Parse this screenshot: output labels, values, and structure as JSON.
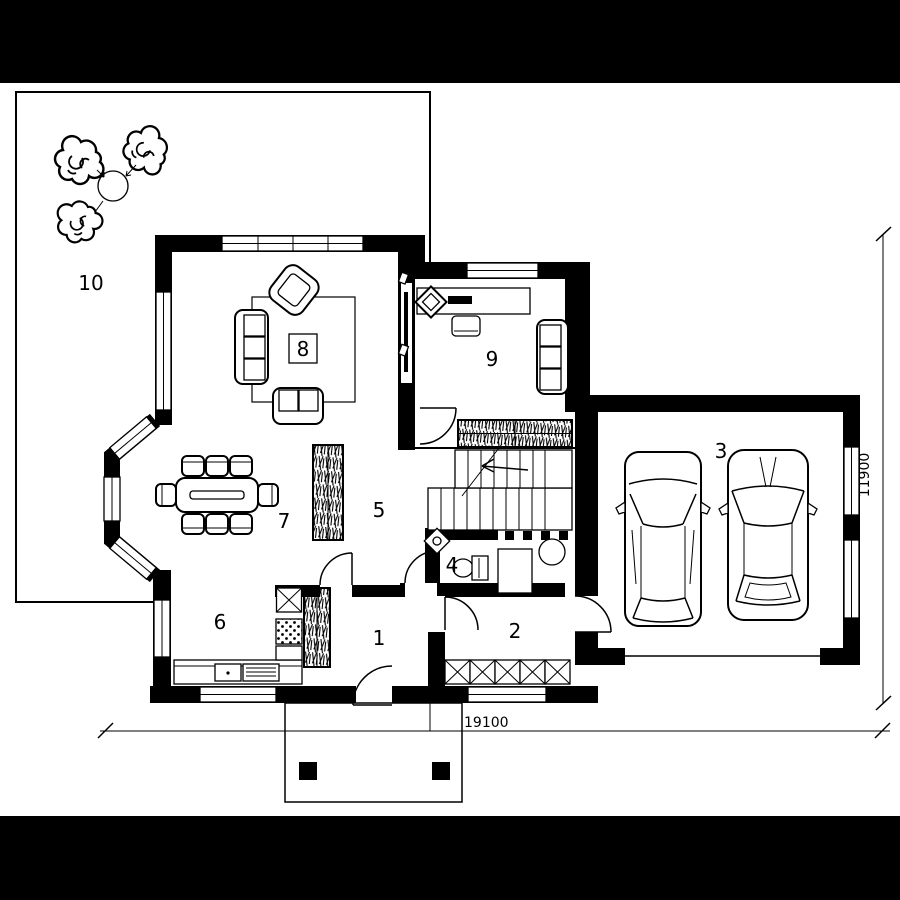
{
  "rooms": {
    "r1": "1",
    "r2": "2",
    "r3": "3",
    "r4": "4",
    "r5": "5",
    "r6": "6",
    "r7": "7",
    "r8": "8",
    "r9": "9",
    "r10": "10"
  },
  "dimensions": {
    "bottom": "19100",
    "right": "11900"
  },
  "colors": {
    "ink": "#000000",
    "paper": "#ffffff"
  }
}
